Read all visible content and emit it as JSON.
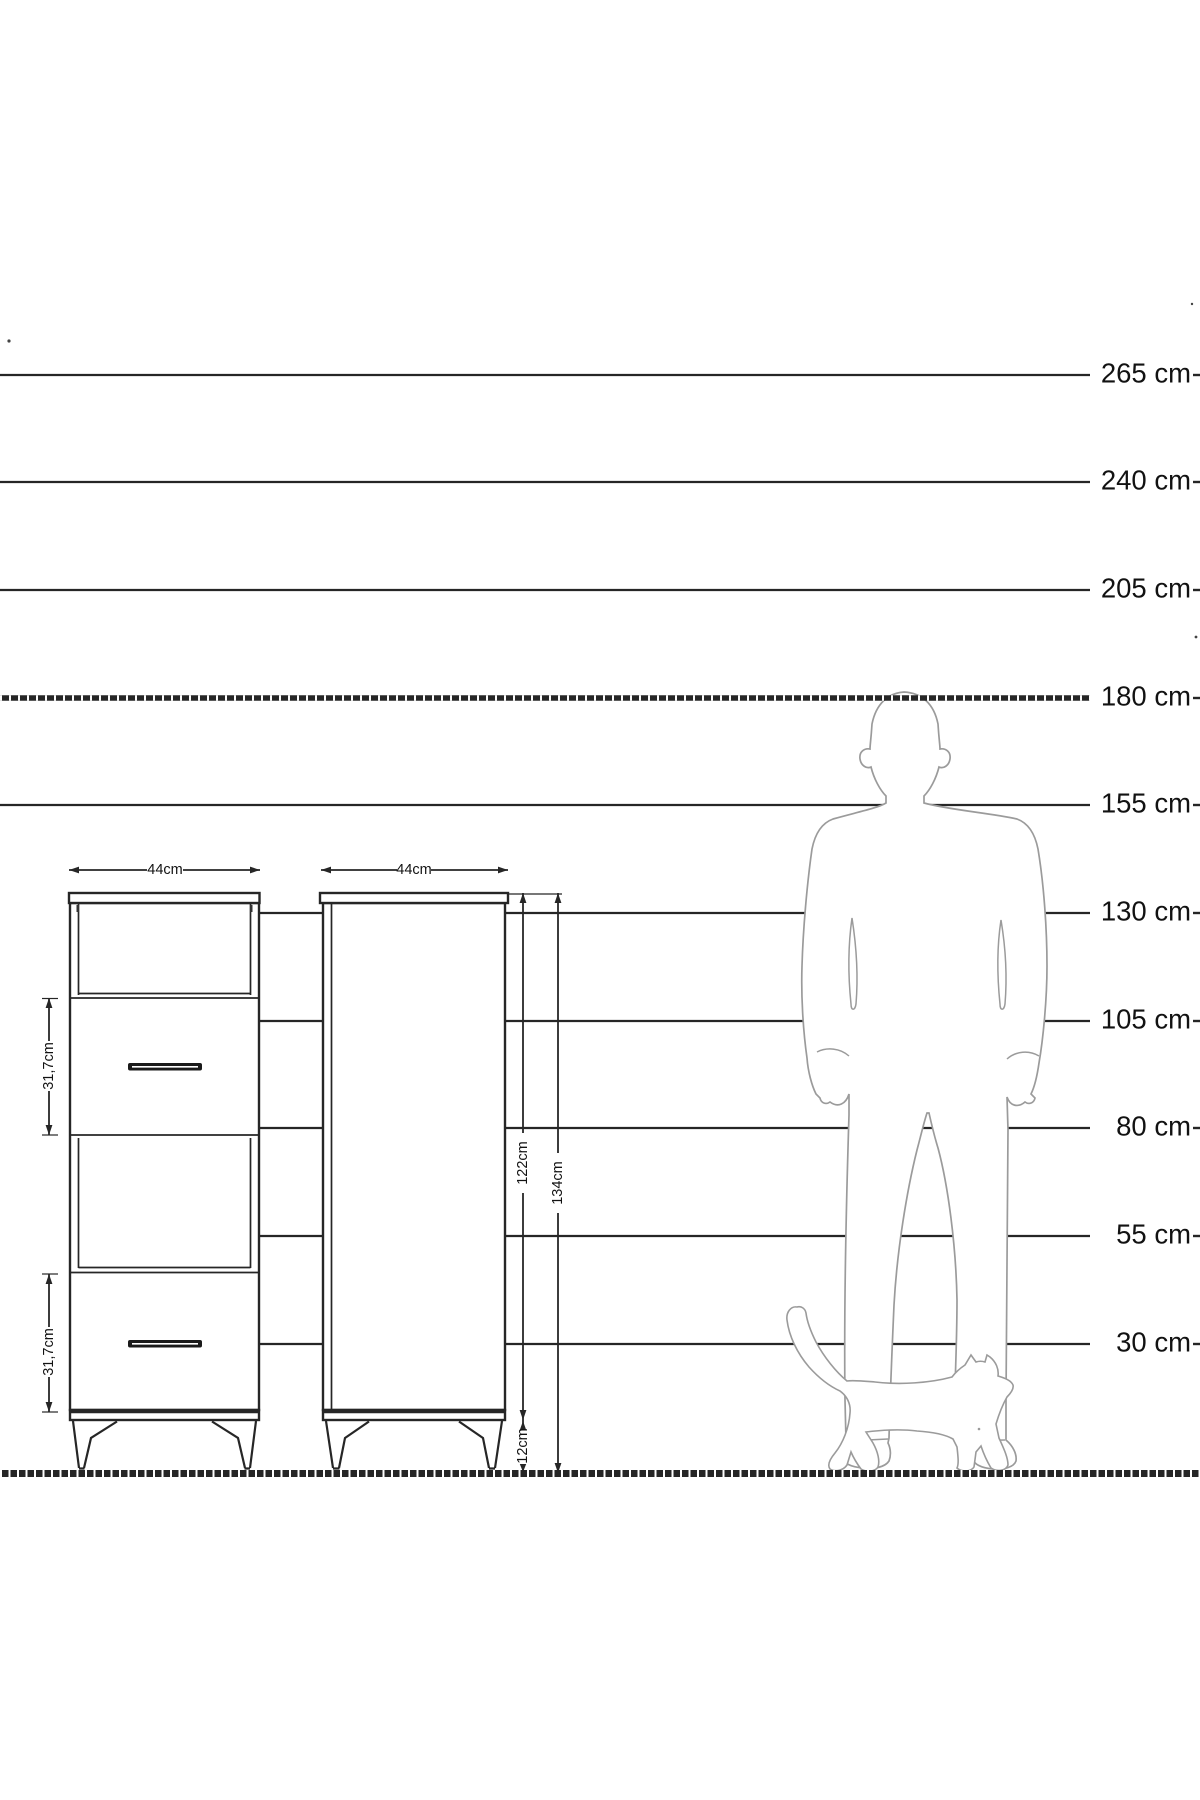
{
  "scale": {
    "unit": "cm",
    "labels": [
      "265 cm",
      "240 cm",
      "205 cm",
      "180 cm",
      "155 cm",
      "130 cm",
      "105 cm",
      "80 cm",
      "55 cm",
      "30 cm"
    ]
  },
  "dimensions": {
    "cabinet1_width": "44cm",
    "cabinet2_width": "44cm",
    "drawer1_height": "31,7cm",
    "drawer2_height": "31,7cm",
    "cabinet_body_height": "122cm",
    "cabinet_total_height": "134cm",
    "leg_height": "12cm"
  },
  "colors": {
    "line": "#262626",
    "text": "#121212",
    "silhouette": "#9b9b9b",
    "bg": "#ffffff"
  }
}
